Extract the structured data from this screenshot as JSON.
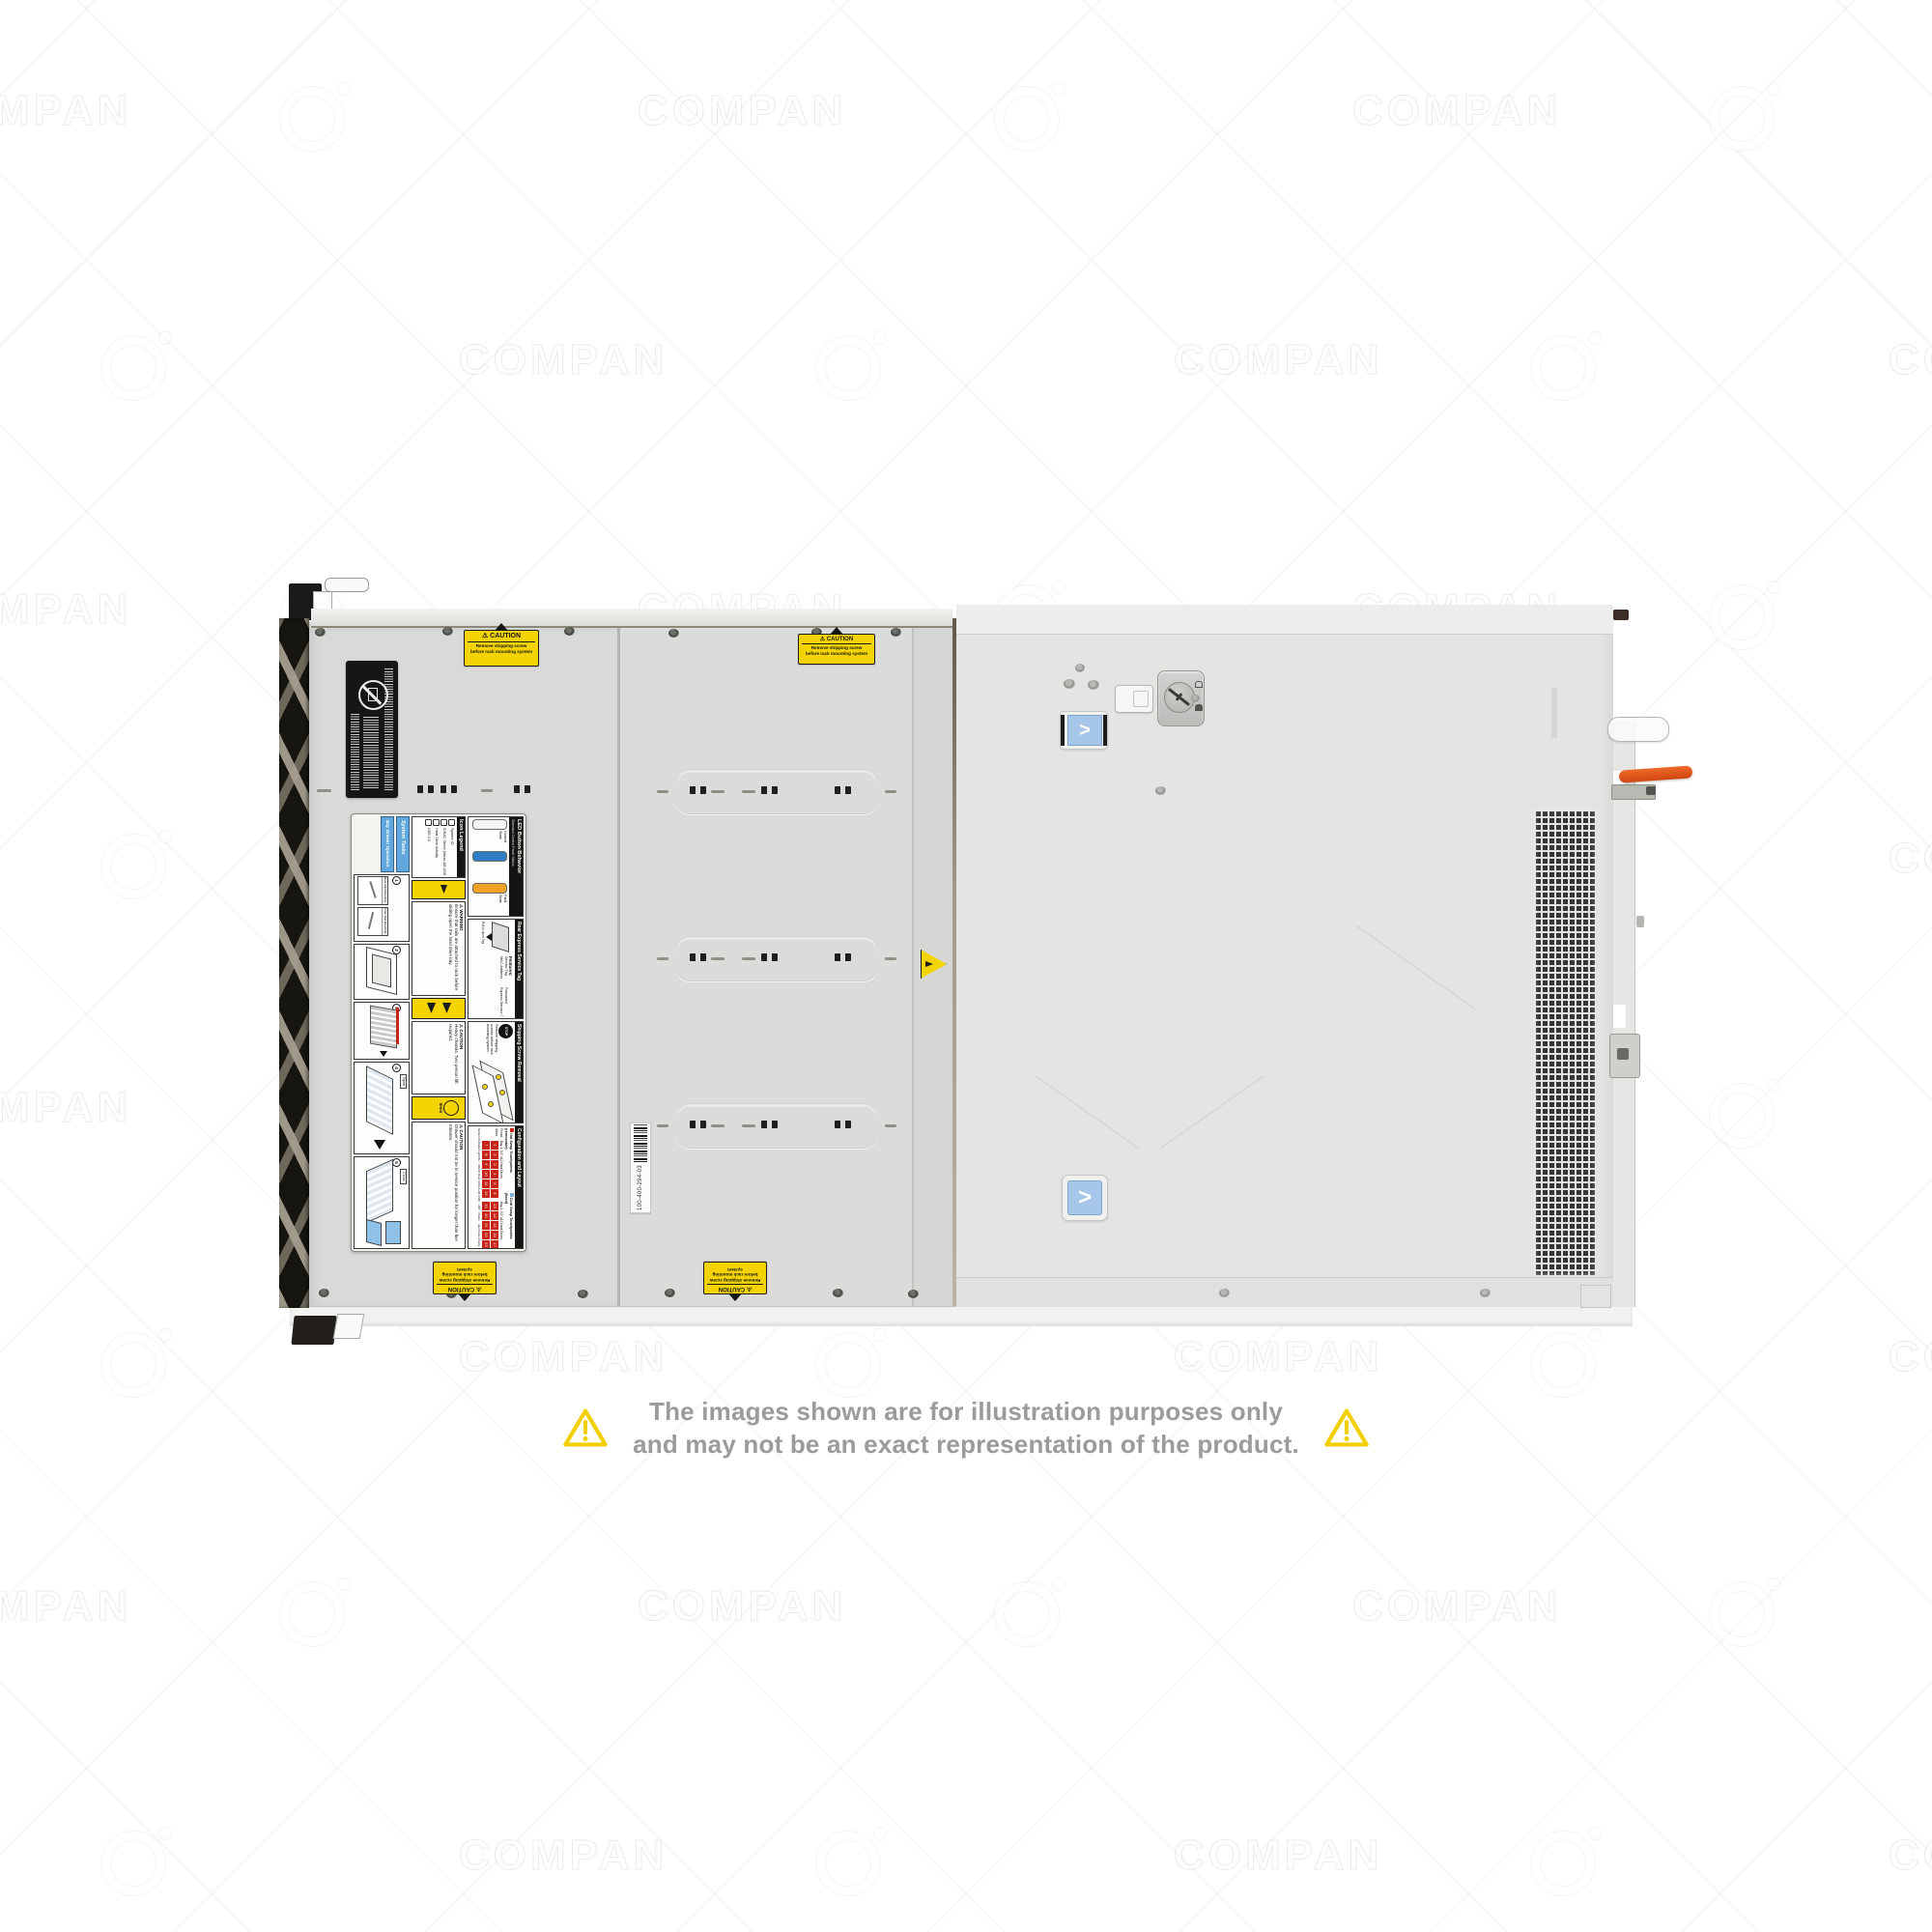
{
  "watermark": {
    "text": "COMPAN"
  },
  "disclaimer": {
    "line1": "The images shown are for illustration purposes only",
    "line2": "and may not be an exact representation of the product."
  },
  "caution_label": {
    "header": "⚠ CAUTION",
    "line1": "Remove shipping screw",
    "line2": "before rack mounting system"
  },
  "barcode_label": {
    "text": "100-400-294-03"
  },
  "icons": {
    "chevron": ">"
  },
  "colors": {
    "caution_yellow": "#f3d402",
    "touchpoint_blue": "#a6c7e9",
    "lever_orange": "#e2571e",
    "bay_red": "#c8251a",
    "led_blue": "#2f7ec6",
    "led_orange": "#f0a227"
  },
  "service_label": {
    "led": {
      "header": "LED Button Behavior",
      "subheader": "Standard Control Panel Status",
      "states": [
        {
          "label": "Normal State",
          "color": "#f4f4f2"
        },
        {
          "label": "",
          "color": "#2f7ec6"
        },
        {
          "label": "Fault State",
          "color": "#f0a227"
        }
      ]
    },
    "service_tag": {
      "header": "Rear Express Service Tag",
      "note": "Pull to open Tag",
      "features_title": "Features:",
      "features": [
        "Service Tag",
        "Password",
        "MAC Address",
        "Express Service Code"
      ]
    },
    "shipping": {
      "header": "Shipping Screw Removal",
      "stop": "STOP",
      "text": "Remove shipping screws before rack mounting system."
    },
    "config": {
      "header": "Configuration and Layout",
      "legend_hot": "Hot Swap Touchpoints (removable)",
      "legend_cold": "Cold Swap Touchpoints (fixed)",
      "front_view": "Front View",
      "bay1_label": "Bay 1: 3.5\" x12 Hard Drives",
      "bay2_label": "Bay 2: 3.5\" x12 Hard Drives",
      "bay1": [
        1,
        2,
        3,
        4,
        5,
        6,
        7,
        8,
        9,
        10,
        11,
        12
      ],
      "bay2": [
        13,
        14,
        15,
        16,
        17,
        18,
        19,
        20,
        21,
        22,
        23,
        24
      ],
      "captions": [
        "System ID/Status Light Bar",
        "iDRAC Direct (Micro-AB USB)",
        "USB",
        "Power",
        "Hard Drive Activity"
      ]
    },
    "icon_legend": {
      "header": "Icon Legend",
      "items": [
        {
          "label": "System ID"
        },
        {
          "label": "iDRAC Direct (Micro-AB USB)"
        },
        {
          "label": "Hard Drive Activity"
        },
        {
          "label": "USB 2.0"
        }
      ]
    },
    "warnings": {
      "warning_title": "⚠ WARNING",
      "warning_text": "Ensure that rails are attached to rack before sliding open the hard drive bay.",
      "caution1_title": "⚠ CAUTION",
      "caution1_text": "Heavy chassis. Two person lift required.",
      "five_min": "5min",
      "caution2_title": "⚠ CAUTION",
      "caution2_text": "Drawer should not be in service position for longer than five minutes."
    },
    "tasks": {
      "header1": "System Tasks",
      "header2": "Bay Drawer Operation",
      "steps": [
        "1",
        "2",
        "3",
        "4",
        "5"
      ],
      "rear_rail": "Rear Rail Mounting",
      "front_rail": "Front Rail Mounting",
      "open": "Open",
      "close": "Close"
    }
  }
}
